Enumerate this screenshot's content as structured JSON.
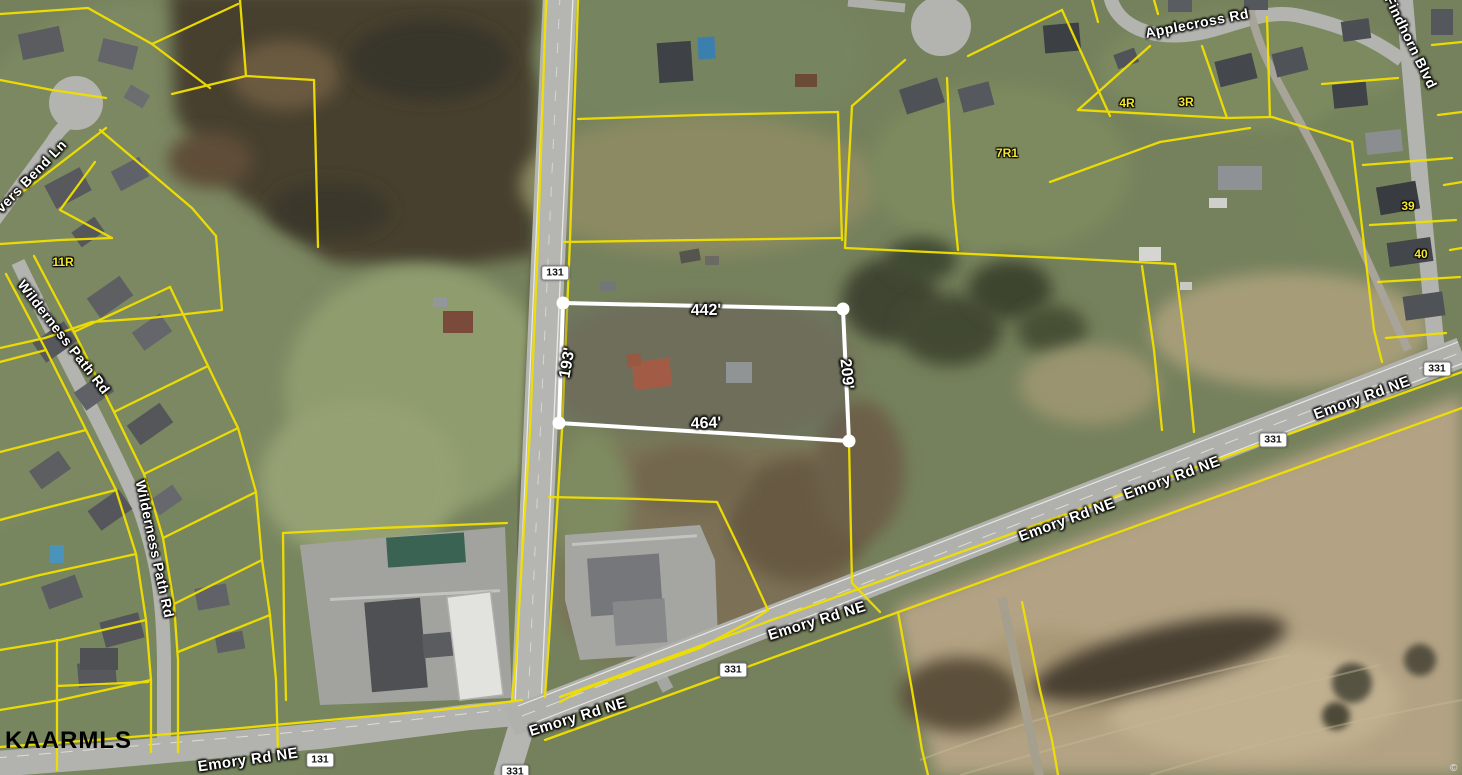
{
  "map": {
    "watermark": "KAARMLS",
    "copyright_mark": "©",
    "colors": {
      "parcel_line": "#f0df00",
      "subject_outline": "#ffffff",
      "shield_bg": "#ffffff",
      "label_text": "#ffffff",
      "parcel_id_text": "#f5e82e"
    },
    "subject_parcel": {
      "dim_top": "442'",
      "dim_left": "193'",
      "dim_right": "209'",
      "dim_bottom": "464'"
    },
    "parcel_ids": {
      "p_11r": "11R",
      "p_7r1": "7R1",
      "p_4r": "4R",
      "p_3r": "3R",
      "p_39": "39",
      "p_40": "40"
    },
    "road_labels": {
      "applecross": "Applecross Rd",
      "findhorn": "Findhorn Blvd",
      "bend_ln": "vers Bend Ln",
      "wilderness_upper": "Wilderness Path Rd",
      "wilderness_lower": "Wilderness Path Rd",
      "emory_sw": "Emory Rd NE",
      "emory_center": "Emory Rd NE",
      "emory_mid": "Emory Rd NE",
      "emory_east_1": "Emory Rd NE",
      "emory_east_2": "Emory Rd NE",
      "emory_far_east": "Emory Rd NE"
    },
    "route_shields": {
      "sh_131_north": "131",
      "sh_131_south": "131",
      "sh_331_center": "331",
      "sh_331_east": "331",
      "sh_331_far_east": "331",
      "sh_331_south": "331"
    }
  }
}
